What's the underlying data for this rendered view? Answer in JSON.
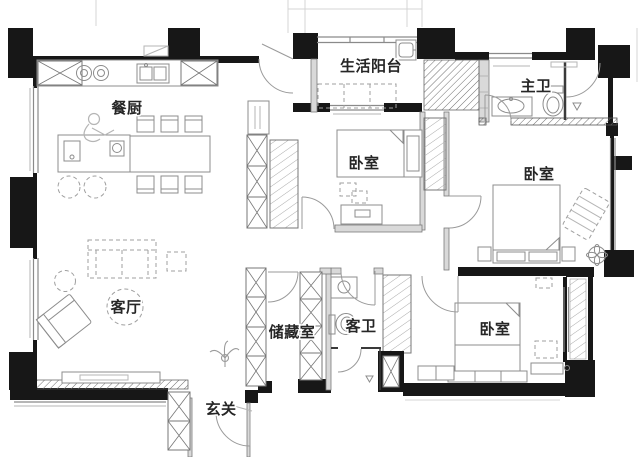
{
  "document": {
    "type": "apartment-floor-plan"
  },
  "rooms": [
    {
      "id": "dining-kitchen",
      "label": "餐厨"
    },
    {
      "id": "balcony",
      "label": "生活阳台"
    },
    {
      "id": "master-bath",
      "label": "主卫"
    },
    {
      "id": "bedroom-north",
      "label": "卧室"
    },
    {
      "id": "bedroom-east",
      "label": "卧室"
    },
    {
      "id": "living-room",
      "label": "客厅"
    },
    {
      "id": "storage",
      "label": "储藏室"
    },
    {
      "id": "guest-bath",
      "label": "客卫"
    },
    {
      "id": "bedroom-south",
      "label": "卧室"
    },
    {
      "id": "entry",
      "label": "玄关"
    }
  ],
  "colors": {
    "background": "#ffffff",
    "wall": "#171717",
    "partition": "#d9d9d9",
    "furniture_line": "#8c8c8c",
    "label_text": "#262626"
  }
}
